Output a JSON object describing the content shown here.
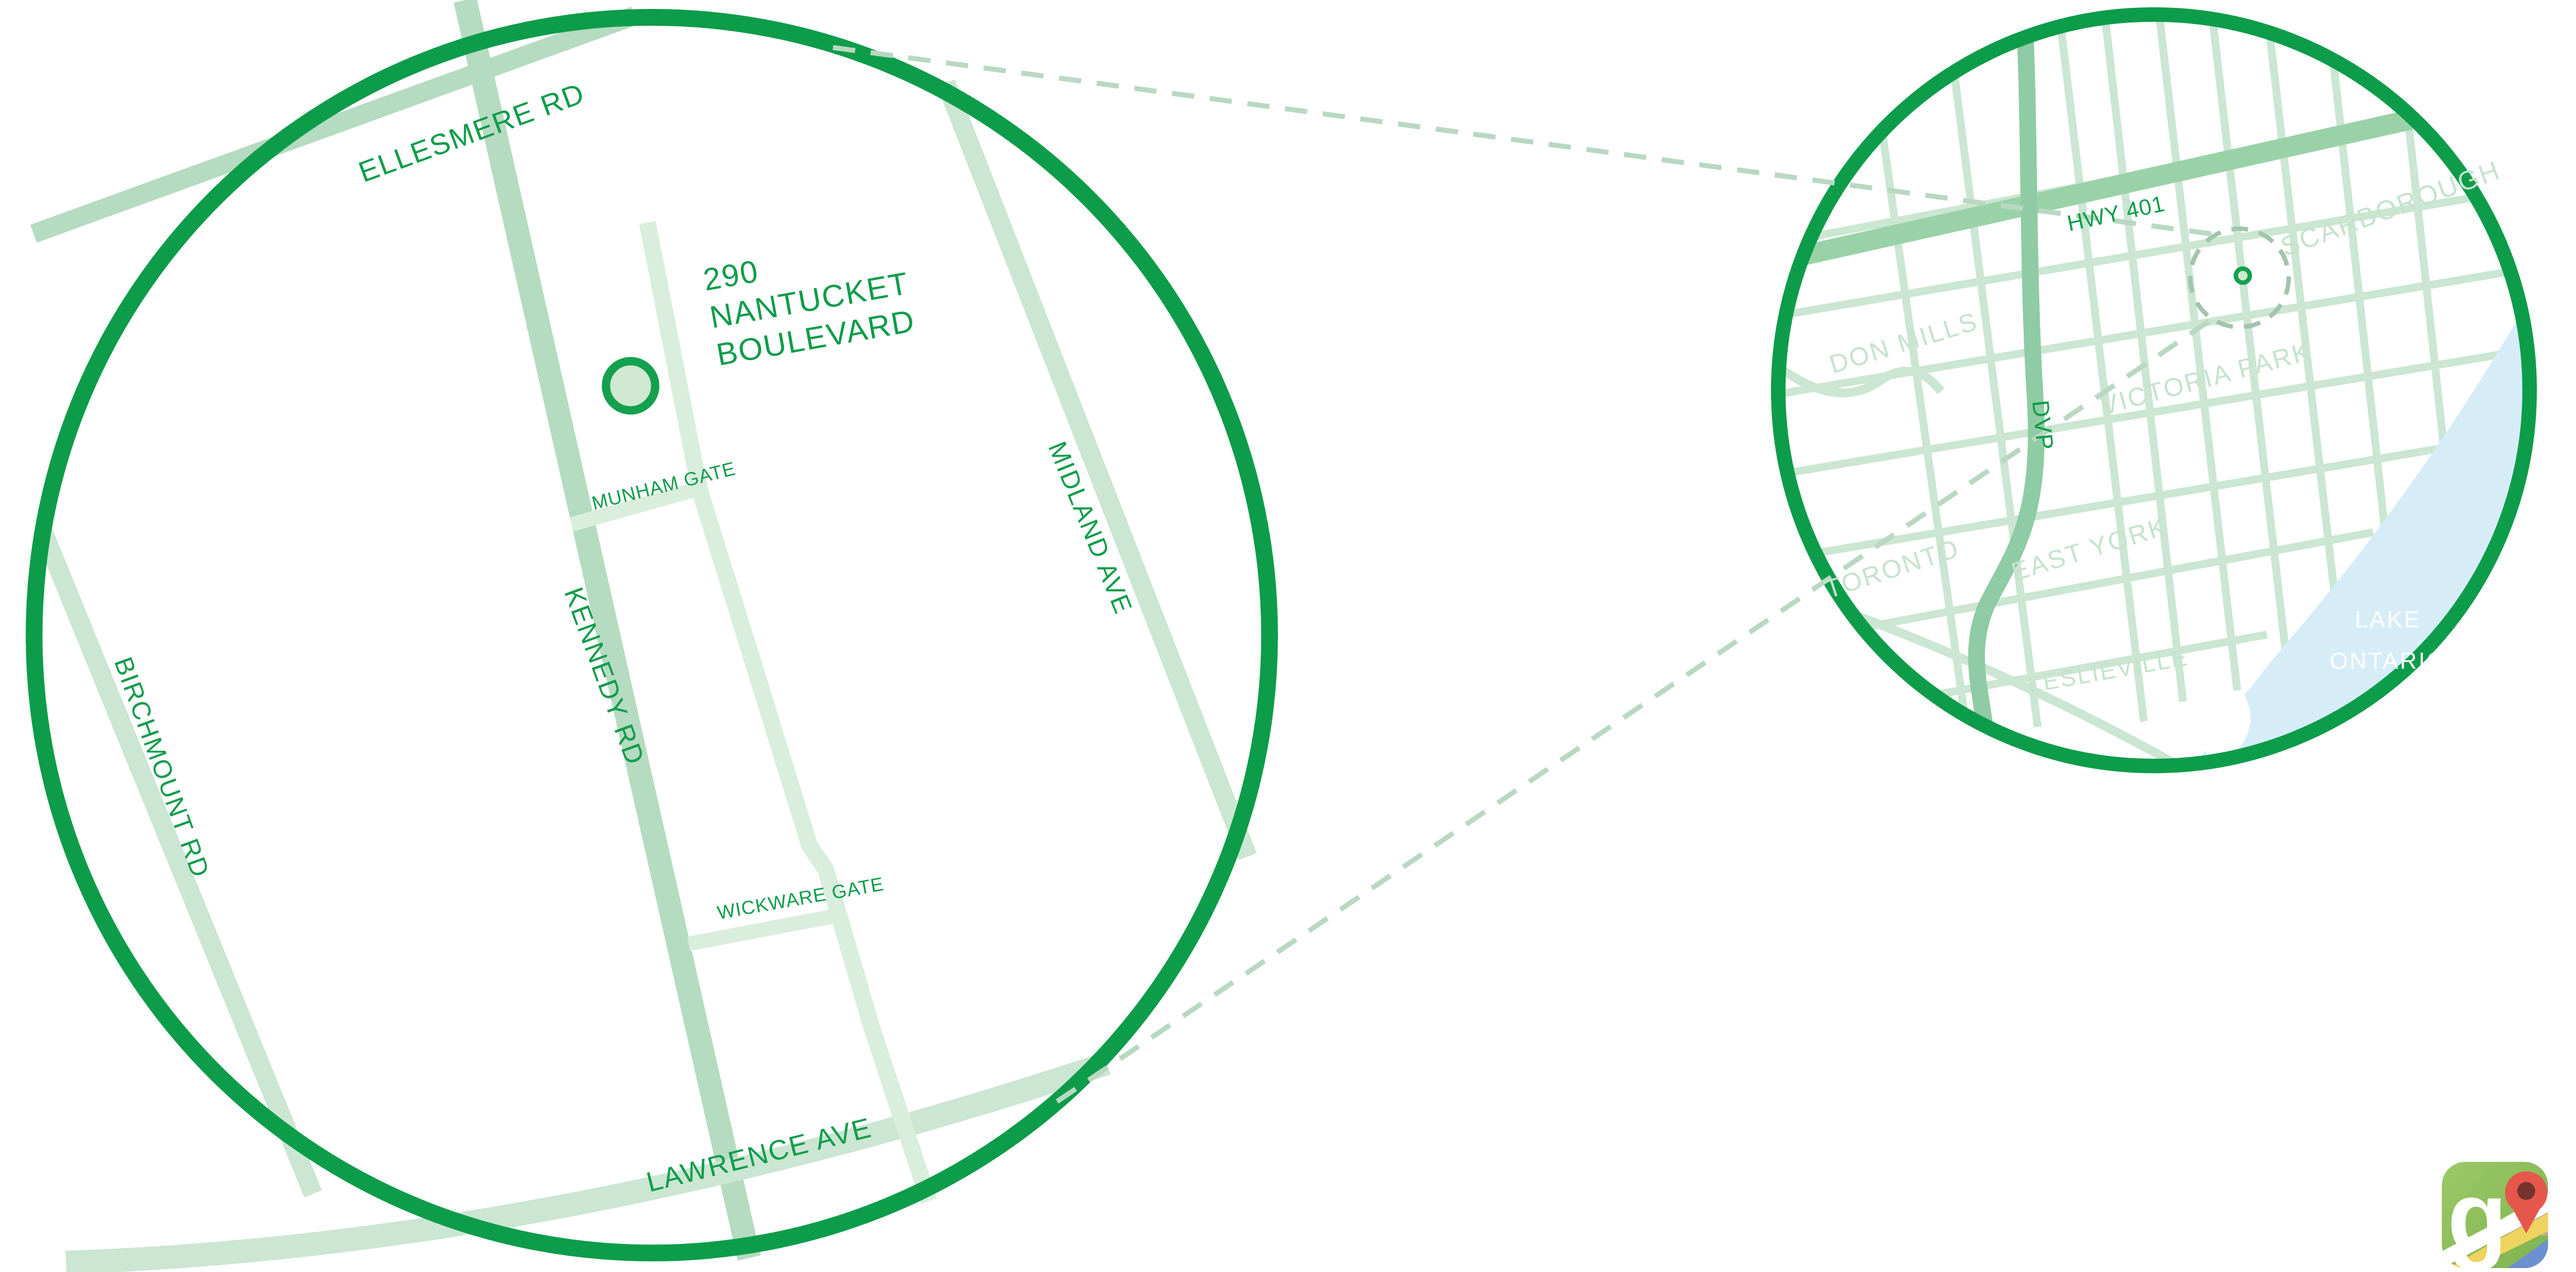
{
  "title": "290 Nantucket Boulevard location map",
  "colors": {
    "circle_border": "#0d9c4a",
    "road_label_green": "#0d9c4a",
    "road_medium": "#b5dbc0",
    "road_light": "#cbe6d2",
    "road_lightest": "#d9eedd",
    "highway_green": "#9ad2a8",
    "dvp_green": "#8fcba4",
    "area_label_pale": "#c5e3cd",
    "lake_blue": "#d6edf8",
    "lake_label_white": "#ffffff",
    "marker_ring": "#14a04f",
    "marker_fill": "#cfe8cf",
    "connector_dash": "#b9d8c2",
    "dashed_radius_ring": "#a3c4ad"
  },
  "detail_map": {
    "address": {
      "line1": "290",
      "line2": "NANTUCKET",
      "line3": "BOULEVARD"
    },
    "road_labels": {
      "ellesmere": "ELLESMERE RD",
      "kennedy": "KENNEDY RD",
      "birchmount": "BIRCHMOUNT RD",
      "midland": "MIDLAND AVE",
      "lawrence": "LAWRENCE AVE",
      "munham": "MUNHAM GATE",
      "wickware": "WICKWARE GATE"
    }
  },
  "overview_map": {
    "road_labels": {
      "hwy401": "HWY 401",
      "dvp": "DVP"
    },
    "area_labels": {
      "scarborough": "SCARBOROUGH",
      "don_mills": "DON MILLS",
      "victoria_park": "VICTORIA PARK",
      "toronto": "TORONTO",
      "east_york": "EAST YORK",
      "leslieville": "LESLIEVILLE"
    },
    "lake_label": {
      "line1": "LAKE",
      "line2": "ONTARIO"
    }
  },
  "branding": {
    "google_letter": "g"
  }
}
